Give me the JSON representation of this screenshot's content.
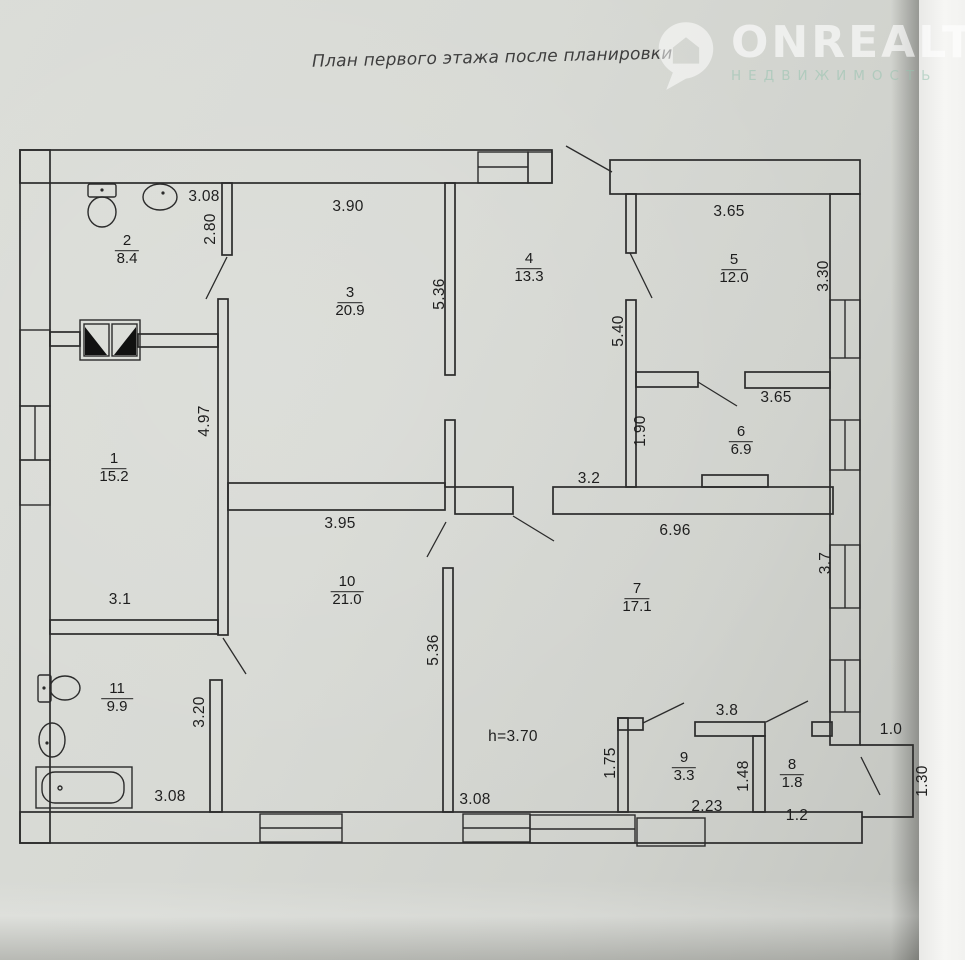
{
  "header": {
    "title": "План первого этажа после планировки"
  },
  "watermark": {
    "brand": "ONREALT",
    "subtitle": "НЕДВИЖИМОСТЬ",
    "icon": "house-pin-icon"
  },
  "colors": {
    "ink": "#2b2b2b",
    "paper": "#d7d9d4",
    "watermark_brand": "#ffffff",
    "watermark_subtitle": "#96c3af",
    "page_edge": "#f6f6f4"
  },
  "plan": {
    "rooms": [
      {
        "number": "1",
        "area": "15.2"
      },
      {
        "number": "2",
        "area": "8.4"
      },
      {
        "number": "3",
        "area": "20.9"
      },
      {
        "number": "4",
        "area": "13.3"
      },
      {
        "number": "5",
        "area": "12.0"
      },
      {
        "number": "6",
        "area": "6.9"
      },
      {
        "number": "7",
        "area": "17.1"
      },
      {
        "number": "8",
        "area": "1.8"
      },
      {
        "number": "9",
        "area": "3.3"
      },
      {
        "number": "10",
        "area": "21.0"
      },
      {
        "number": "11",
        "area": "9.9"
      }
    ],
    "dimensions": {
      "d308a": "3.08",
      "d390": "3.90",
      "d280": "2.80",
      "d536a": "5.36",
      "d365a": "3.65",
      "d330": "3.30",
      "d540": "5.40",
      "d190": "1.90",
      "d365b": "3.65",
      "d32": "3.2",
      "d696": "6.96",
      "d395": "3.95",
      "d497": "4.97",
      "d31": "3.1",
      "d536b": "5.36",
      "d37": "3.7",
      "d320": "3.20",
      "dh": "h=3.70",
      "d175": "1.75",
      "d38": "3.8",
      "d10": "1.0",
      "d148": "1.48",
      "d223": "2.23",
      "d12": "1.2",
      "d130": "1.30",
      "d308b": "3.08",
      "d308c": "3.08"
    }
  }
}
